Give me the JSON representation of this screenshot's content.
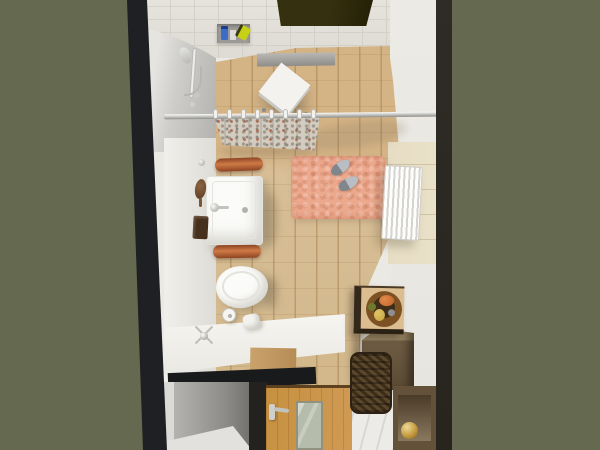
{
  "scene": {
    "description": "Top-down 3D interior rendering of a narrow bathroom",
    "room": "bathroom",
    "view": "overhead"
  },
  "objects": [
    {
      "name": "skylight-window",
      "label": "Dark ceiling window opening"
    },
    {
      "name": "shower-head",
      "label": "Wall-mounted hand shower with hose"
    },
    {
      "name": "shower-shelf",
      "label": "Shelf with shampoo bottles (blue, white, lime)"
    },
    {
      "name": "curtain-rod",
      "label": "Chrome shower curtain rod with white rings"
    },
    {
      "name": "shower-curtain",
      "label": "Speckled beige shower curtain"
    },
    {
      "name": "shower-stool",
      "label": "White rolling stool turned diagonally"
    },
    {
      "name": "washbasin",
      "label": "White rectangular washbasin with chrome faucet"
    },
    {
      "name": "towel-rail-upper",
      "label": "Rolled orange towel on rail"
    },
    {
      "name": "towel-rail-lower",
      "label": "Rolled orange towel on rail"
    },
    {
      "name": "hairbrush",
      "label": "Wooden hairbrush on counter"
    },
    {
      "name": "soap-tray",
      "label": "Dark brown tray"
    },
    {
      "name": "toilet",
      "label": "White toilet seen from above"
    },
    {
      "name": "toilet-paper-holder",
      "label": "Toilet paper roll"
    },
    {
      "name": "bath-mat",
      "label": "Fluffy salmon-pink bath mat"
    },
    {
      "name": "slippers",
      "label": "Pair of gray slippers on mat"
    },
    {
      "name": "towel-radiator",
      "label": "White panel radiator on right wall"
    },
    {
      "name": "fruit-bowl",
      "label": "Decorative bowl with orange, pear and green fruit"
    },
    {
      "name": "storage-cabinet",
      "label": "Brown storage cabinet"
    },
    {
      "name": "wicker-basket",
      "label": "Dark wicker laundry basket"
    },
    {
      "name": "display-cabinet",
      "label": "Open cabinet with gold sphere"
    },
    {
      "name": "entry-door",
      "label": "Wooden door with frosted glass insert and chrome lever handle"
    },
    {
      "name": "wood-floor",
      "label": "Light wood-look plank tile floor"
    }
  ],
  "colors": {
    "background": "#65694f",
    "edge_left": "#1e2023",
    "edge_right": "#28241e",
    "wall_white": "#ebe9e3",
    "ceiling": "#e5e3db",
    "ceiling_line": "#d3d1c7",
    "skylight": "#35300f",
    "shower_wall": "#b3b1ad",
    "floor": "#d8bf97",
    "curtain": "#d3ccc0",
    "mat": "#eca98e",
    "slipper": "#b9bec4",
    "sink": "#fbfbf9",
    "towel": "#cf7a46",
    "brush": "#5c3c24",
    "tray": "#46301d",
    "toilet": "#fbfbf9",
    "bench": "#f6f5f1",
    "niche": "#8d8c88",
    "door": "#d09a55",
    "door_glass": "#b6bcab",
    "handle": "#c2c2be",
    "cabinet": "#6e5c44",
    "basket": "#3c2d19",
    "bowl": "#7c5124",
    "fruit_orange": "#c06127",
    "fruit_pear": "#c3a23c",
    "fruit_green": "#6f7a2c",
    "gold": "#c59a3f",
    "radiator": "#f4f3ef",
    "tile_patch": "#e9e0c8",
    "bottle_blue": "#3a6cc8",
    "bottle_green": "#c6d014",
    "hall_floor": "#edebe7",
    "fruit_top": "#dcbd90"
  }
}
